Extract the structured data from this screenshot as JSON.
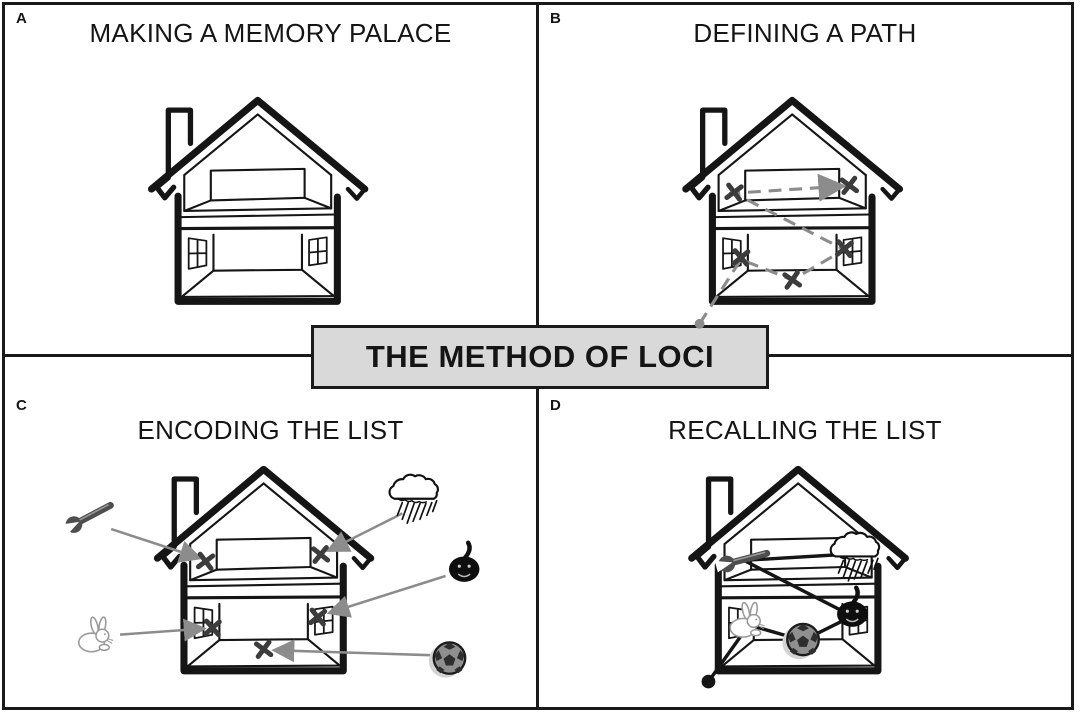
{
  "banner": {
    "label": "THE METHOD OF LOCI"
  },
  "panels": [
    {
      "letter": "A",
      "title": "MAKING A MEMORY PALACE"
    },
    {
      "letter": "B",
      "title": "DEFINING A PATH"
    },
    {
      "letter": "C",
      "title": "ENCODING THE LIST"
    },
    {
      "letter": "D",
      "title": "RECALLING THE LIST"
    }
  ],
  "icons": [
    "wrench",
    "storm-cloud",
    "pumpkin",
    "rabbit",
    "soccer-ball",
    "house",
    "x-mark"
  ],
  "loci_count": 5,
  "colors": {
    "banner_bg": "#d9d9d9",
    "path_gray": "#8c8c8c",
    "x_mark": "#3c3c3c",
    "ink": "#151515",
    "background": "#ffffff"
  }
}
